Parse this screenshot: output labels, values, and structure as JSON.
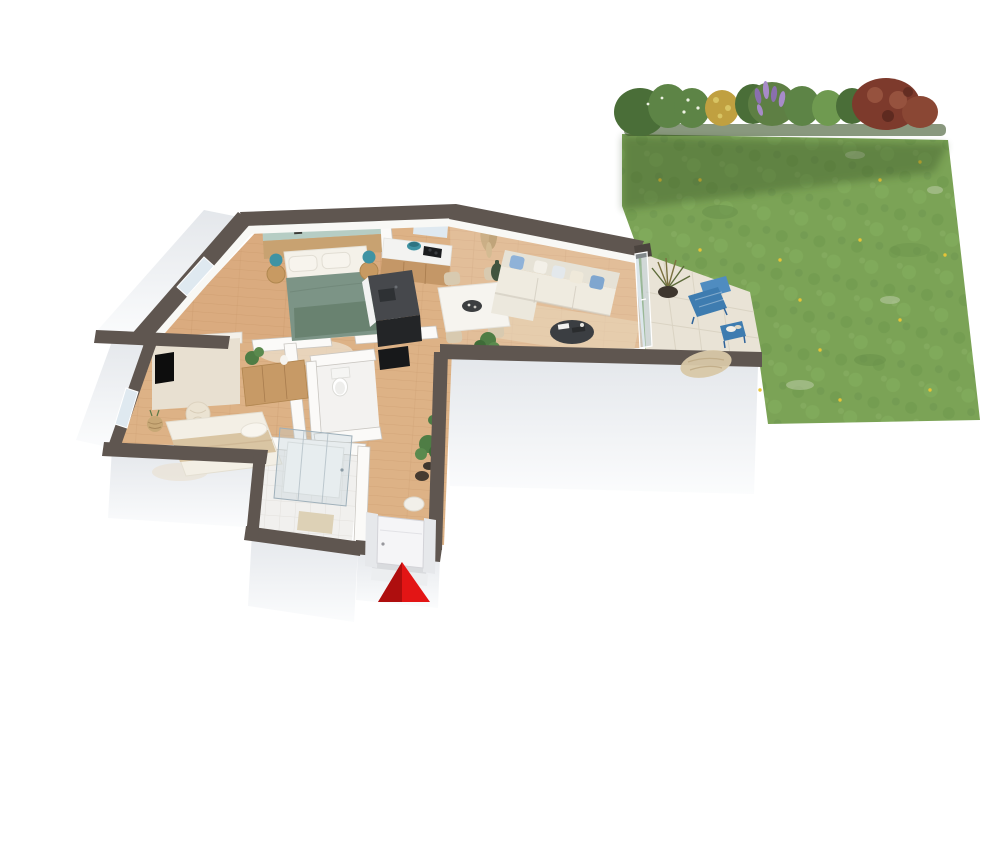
{
  "scene": {
    "kind": "3d-floor-plan-rendering",
    "areas": [
      "garden-lawn",
      "flower-hedge",
      "terrace",
      "living-room",
      "kitchen",
      "dining-area",
      "master-bedroom",
      "second-bedroom",
      "bathroom",
      "wc",
      "corridor",
      "entrance"
    ],
    "marker": "red-entrance-arrow"
  },
  "palette": {
    "page_bg": "#ffffff",
    "lawn": "#7ba356",
    "lawn_dark": "#6b934c",
    "lawn_speckle": "#c2cfae",
    "flower_yellow": "#e6c437",
    "hedge_green_dark": "#4a6e38",
    "hedge_green": "#5d8446",
    "hedge_green_light": "#6f9a50",
    "bush_yellow": "#c0a040",
    "bush_purple": "#8a6fae",
    "bush_purple_light": "#a78bc8",
    "bush_red": "#7d3a2c",
    "bush_red_light": "#96523e",
    "wall_cap": "#5f5650",
    "wall_cap_dark": "#4b443f",
    "wall_face": "#eef0f3",
    "interior_wall": "#fbfaf8",
    "wood_floor": "#ddb286",
    "wood_line": "#c89a6e",
    "wood_cabinet": "#c49767",
    "accent_teal": "#b6cdc4",
    "headboard": "#c8a271",
    "duvet": "#7c9486",
    "duvet_dark": "#68816f",
    "bed_white": "#f4f1e9",
    "pillow_blue": "#8fb2d8",
    "pillow_blue_dark": "#7fa6cf",
    "sofa": "#e6e2d6",
    "sofa_seat": "#efebe0",
    "rug": "#ead9bd",
    "coffee_table": "#3b3e42",
    "island_top": "#46484c",
    "island_front": "#232527",
    "cooktop": "#1b1d1f",
    "teal_item": "#3f93a3",
    "table_white": "#f6f4ef",
    "chair_beige": "#d8cab0",
    "bowl_dark": "#3c3e40",
    "accent_beige": "#e8e0d1",
    "blanket": "#d9c5a3",
    "dresser": "#c79a66",
    "pouf": "#ebe3d2",
    "basket": "#c8a876",
    "tv": "#0d0d0d",
    "bath_floor": "#f1f0ee",
    "shower_glass": "#b9cdd8",
    "mat": "#ddd1b6",
    "terrace_stone": "#e9e3d6",
    "terrace_blue": "#3e7cb0",
    "terrace_blue_light": "#4f8cc0",
    "throw": "#d8c8a8",
    "plant": "#4f7d45",
    "plant_dark": "#3f6b38",
    "pot": "#3e362e",
    "arrow_red": "#e31515",
    "arrow_red_dark": "#a50d0d",
    "door_white": "#f5f5f7",
    "window_glass": "#dfe9f0",
    "stool_white": "#f1efe9",
    "toilet": "#ffffff"
  }
}
